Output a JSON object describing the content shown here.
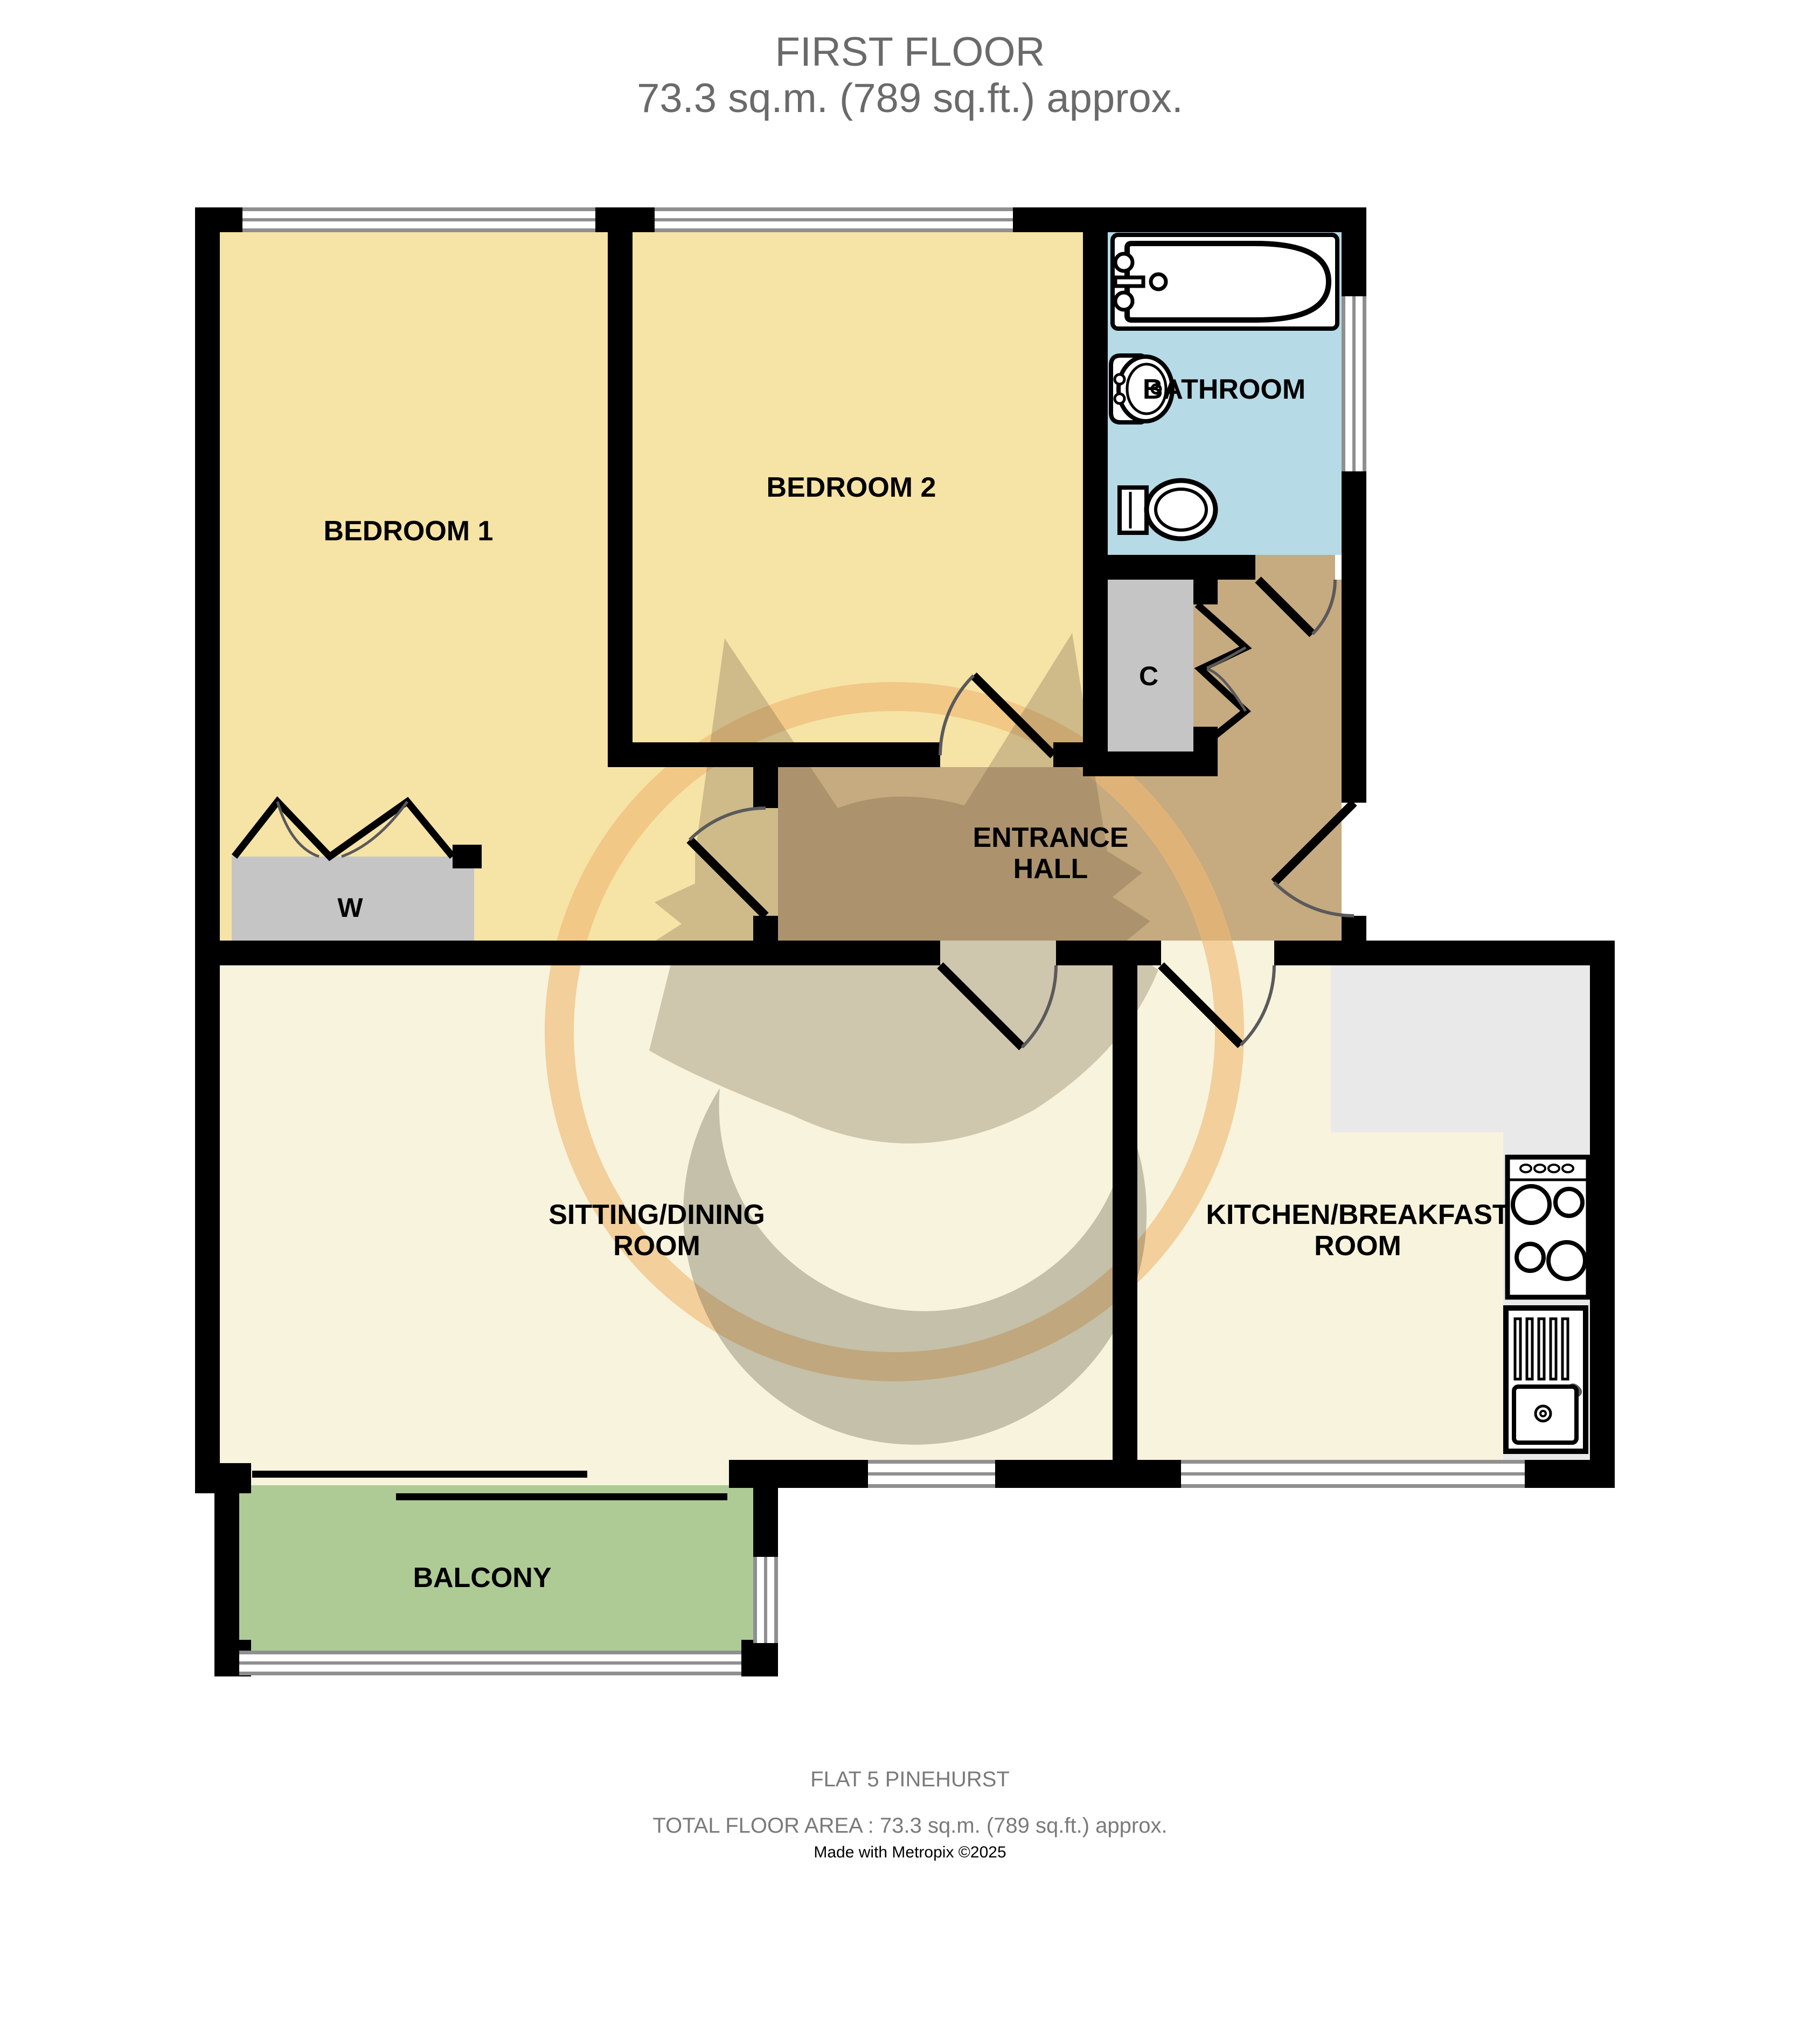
{
  "title": {
    "line1": "FIRST FLOOR",
    "line2": "73.3 sq.m. (789 sq.ft.) approx."
  },
  "floor_plan": {
    "rooms": {
      "bedroom_1": {
        "label": "BEDROOM 1",
        "color": "#F6E3A6"
      },
      "bedroom_2": {
        "label": "BEDROOM 2",
        "color": "#F6E3A6"
      },
      "bathroom": {
        "label": "BATHROOM",
        "color": "#B6DAE6"
      },
      "entrance_hall": {
        "label_line1": "ENTRANCE",
        "label_line2": "HALL",
        "color": "#C6AA80"
      },
      "sitting_dining": {
        "label_line1": "SITTING/DINING",
        "label_line2": "ROOM",
        "color": "#F8F3DC"
      },
      "kitchen": {
        "label_line1": "KITCHEN/BREAKFAST",
        "label_line2": "ROOM",
        "color": "#F8F3DC"
      },
      "balcony": {
        "label": "BALCONY",
        "color": "#AECB96"
      },
      "wardrobe": {
        "label": "W",
        "color": "#C5C5C5"
      },
      "cupboard": {
        "label": "C",
        "color": "#C5C5C5"
      }
    },
    "colors": {
      "wall": "#000000",
      "window_frame": "#8F8F8F",
      "kitchen_counter": "#E9E9E9",
      "door_arc": "#5A5A5A",
      "watermark_ring": "#EFB873",
      "watermark_fox": "#6F6046",
      "watermark_swirl": "#57533D"
    }
  },
  "footer": {
    "line1": "FLAT 5 PINEHURST",
    "line2": "TOTAL FLOOR AREA : 73.3 sq.m. (789 sq.ft.) approx.",
    "line3": "Made with Metropix ©2025"
  }
}
